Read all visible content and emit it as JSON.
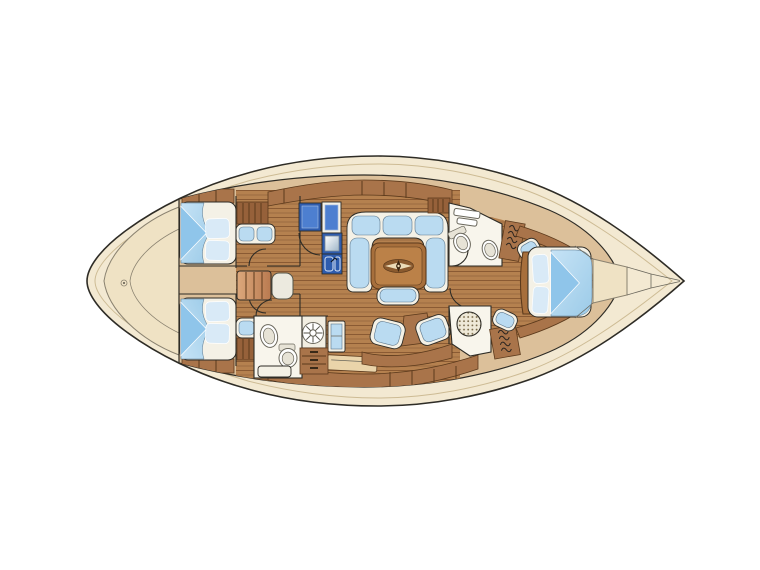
{
  "meta": {
    "type": "sailing-yacht-interior-floor-plan",
    "description": "Top-down interior layout plan of a sailing yacht, bow pointing right",
    "orientation": "bow-right"
  },
  "colors": {
    "background": "#ffffff",
    "hull": "#f3e9d2",
    "hull-edge": "#8a8270",
    "inner-rail": "#cdbb94",
    "deck-shade": "#efe2c4",
    "outline": "#2e2c26",
    "floor": "#dcc09a",
    "teak": "#b5814f",
    "teak-stripe": "#8a5a33",
    "cabinet": "#a9744a",
    "cabinet-line": "#5c3a1c",
    "wood-dark": "#96613a",
    "table": "#a76f3c",
    "table-inner": "#bb8148",
    "surface": "#f4f1e6",
    "cushion": "#badbf1",
    "cushion-line": "#5b768c",
    "bedding-light": "#c6e3f6",
    "bedding-mid": "#9ccbe8",
    "bedding-fold": "#8fc5ea",
    "pillow": "#d9eaf7",
    "galley": "#2e5cae",
    "galley-inner": "#4d7fd0",
    "white-fix": "#f8f5ec",
    "fix-line": "#6a675c"
  },
  "areas": {
    "figure": "yacht interior layout plan",
    "hull": "hull and deck outline",
    "stern_deck": "stern deck",
    "aft_cabin_port": "aft double cabin port",
    "aft_cabin_starboard": "aft double cabin starboard",
    "companionway": "companionway steps",
    "galley": "galley with stove and sink",
    "salon": "salon",
    "settee": "U-shaped settee",
    "table": "salon table with compass rose inlay",
    "salon_bench": "salon bench seat",
    "salon_chairs": "salon chairs",
    "aft_head": "aft head with basin and toilet",
    "shower_fan": "shower grate",
    "fwd_head": "forward head with toilet and basin",
    "fwd_shower": "forward shower with teak grate",
    "wardrobe": "hanging locker",
    "owner_cabin": "forward owner cabin with island berth",
    "bow_locker": "bow anchor locker"
  }
}
